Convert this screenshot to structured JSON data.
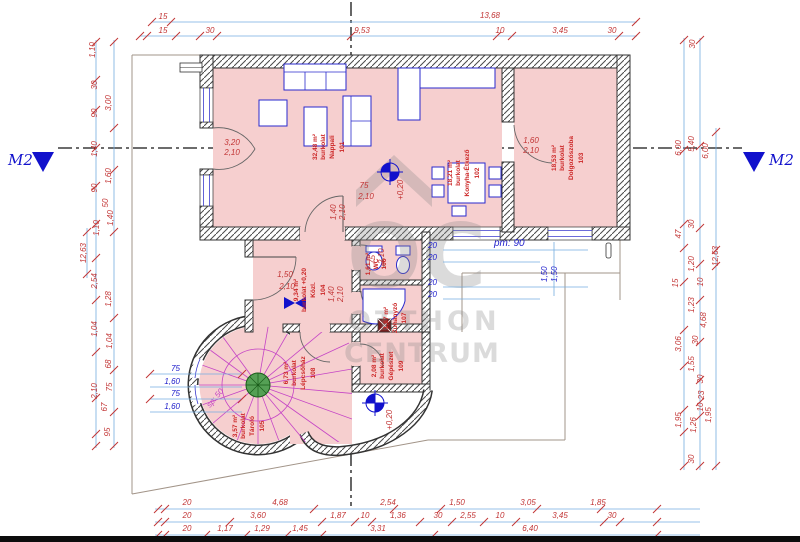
{
  "notes": {
    "m2_left": "M2",
    "m2_right": "M2",
    "level_a": "+0,20",
    "level_b": "+0,20",
    "pm": "pm: 90",
    "stair": "sp: 50"
  },
  "watermark": {
    "monogram": "OC",
    "line1": "OTTHON",
    "line2": "CENTRUM"
  },
  "rooms": {
    "r101": {
      "number": "101",
      "name": "Nappali",
      "floor": "burkolat",
      "area": "32,48 m²"
    },
    "r102": {
      "number": "102",
      "name": "Konyha-Étkező",
      "floor": "burkolat",
      "area": "18,21 m²"
    },
    "r103": {
      "number": "103",
      "name": "Dolgozószoba",
      "floor": "burkolat",
      "area": "18,53 m²"
    },
    "r104": {
      "number": "104",
      "name": "Közl.",
      "floor": "burkolat +0,20",
      "area": "9,34 m²"
    },
    "r105": {
      "number": "105",
      "name": "Tároló",
      "floor": "burkolat",
      "area": "3,57 m²"
    },
    "r106": {
      "number": "106",
      "name": "WC",
      "area": "1,61 m²"
    },
    "r107": {
      "number": "107",
      "name": "Zuhanyzó",
      "area": "1,87 m²"
    },
    "r108": {
      "number": "108",
      "name": "Lépcsőház",
      "floor": "burkolat",
      "area": "6,73 m²"
    },
    "r109": {
      "number": "109",
      "name": "Gépészet",
      "floor": "burkolat",
      "area": "2,08 m²"
    }
  },
  "door_labels": {
    "bay_w": "3,20",
    "bay_h": "2,10",
    "study_w": "1,60",
    "study_h": "2,10",
    "living_w": "1,40",
    "living_h": "2,10",
    "hall_w": "1,50",
    "hall_h": "2,10",
    "kitchen_w": "75",
    "kitchen_h": "2,10",
    "wc_w": "75",
    "wc_h": "2,10",
    "stair_w": "1,40",
    "stair_h": "2,10",
    "window_r": "1,50",
    "window_r2": "1,50"
  },
  "dims": {
    "top1": [
      "15",
      "13,68"
    ],
    "top2": [
      "15",
      "30",
      "9,53",
      "10",
      "3,45",
      "30"
    ],
    "bottom1": [
      "20",
      "4,68",
      "2,54",
      "1,50",
      "3,05",
      "1,85"
    ],
    "bottom2": [
      "20",
      "3,60",
      "1,87",
      "10",
      "1,36",
      "30",
      "2,55",
      "10",
      "3,45",
      "30"
    ],
    "bottom3": [
      "20",
      "1,17",
      "1,29",
      "1,45",
      "3,31",
      "6,40"
    ],
    "left": [
      "1,10",
      "30",
      "3,00",
      "90",
      "1,40",
      "1,60",
      "90",
      "50",
      "1,40",
      "1,10",
      "12,63",
      "2,54",
      "1,28",
      "1,04",
      "1,04",
      "68",
      "2,10",
      "75",
      "67",
      "95"
    ],
    "right": [
      "30",
      "5,40",
      "6,00",
      "6,00",
      "30",
      "47",
      "1,20",
      "12,63",
      "15",
      "10",
      "1,23",
      "4,68",
      "3,06",
      "30",
      "1,55",
      "30",
      "23",
      "10",
      "1,95",
      "1,26",
      "1,95",
      "30"
    ],
    "tower": [
      "75",
      "1,60",
      "75",
      "1,60"
    ],
    "offsets": [
      "20",
      "20",
      "20",
      "20"
    ]
  },
  "colors": {
    "room_fill": "#f6cfcf",
    "dim_text": "#c23535",
    "dim_line": "#74aee0",
    "note_blue": "#2121cc",
    "furniture": "#2a2acc",
    "stair_magenta": "#c544c5",
    "marker_blue": "#1111cc",
    "watermark_gray": "#8a8a8a"
  }
}
